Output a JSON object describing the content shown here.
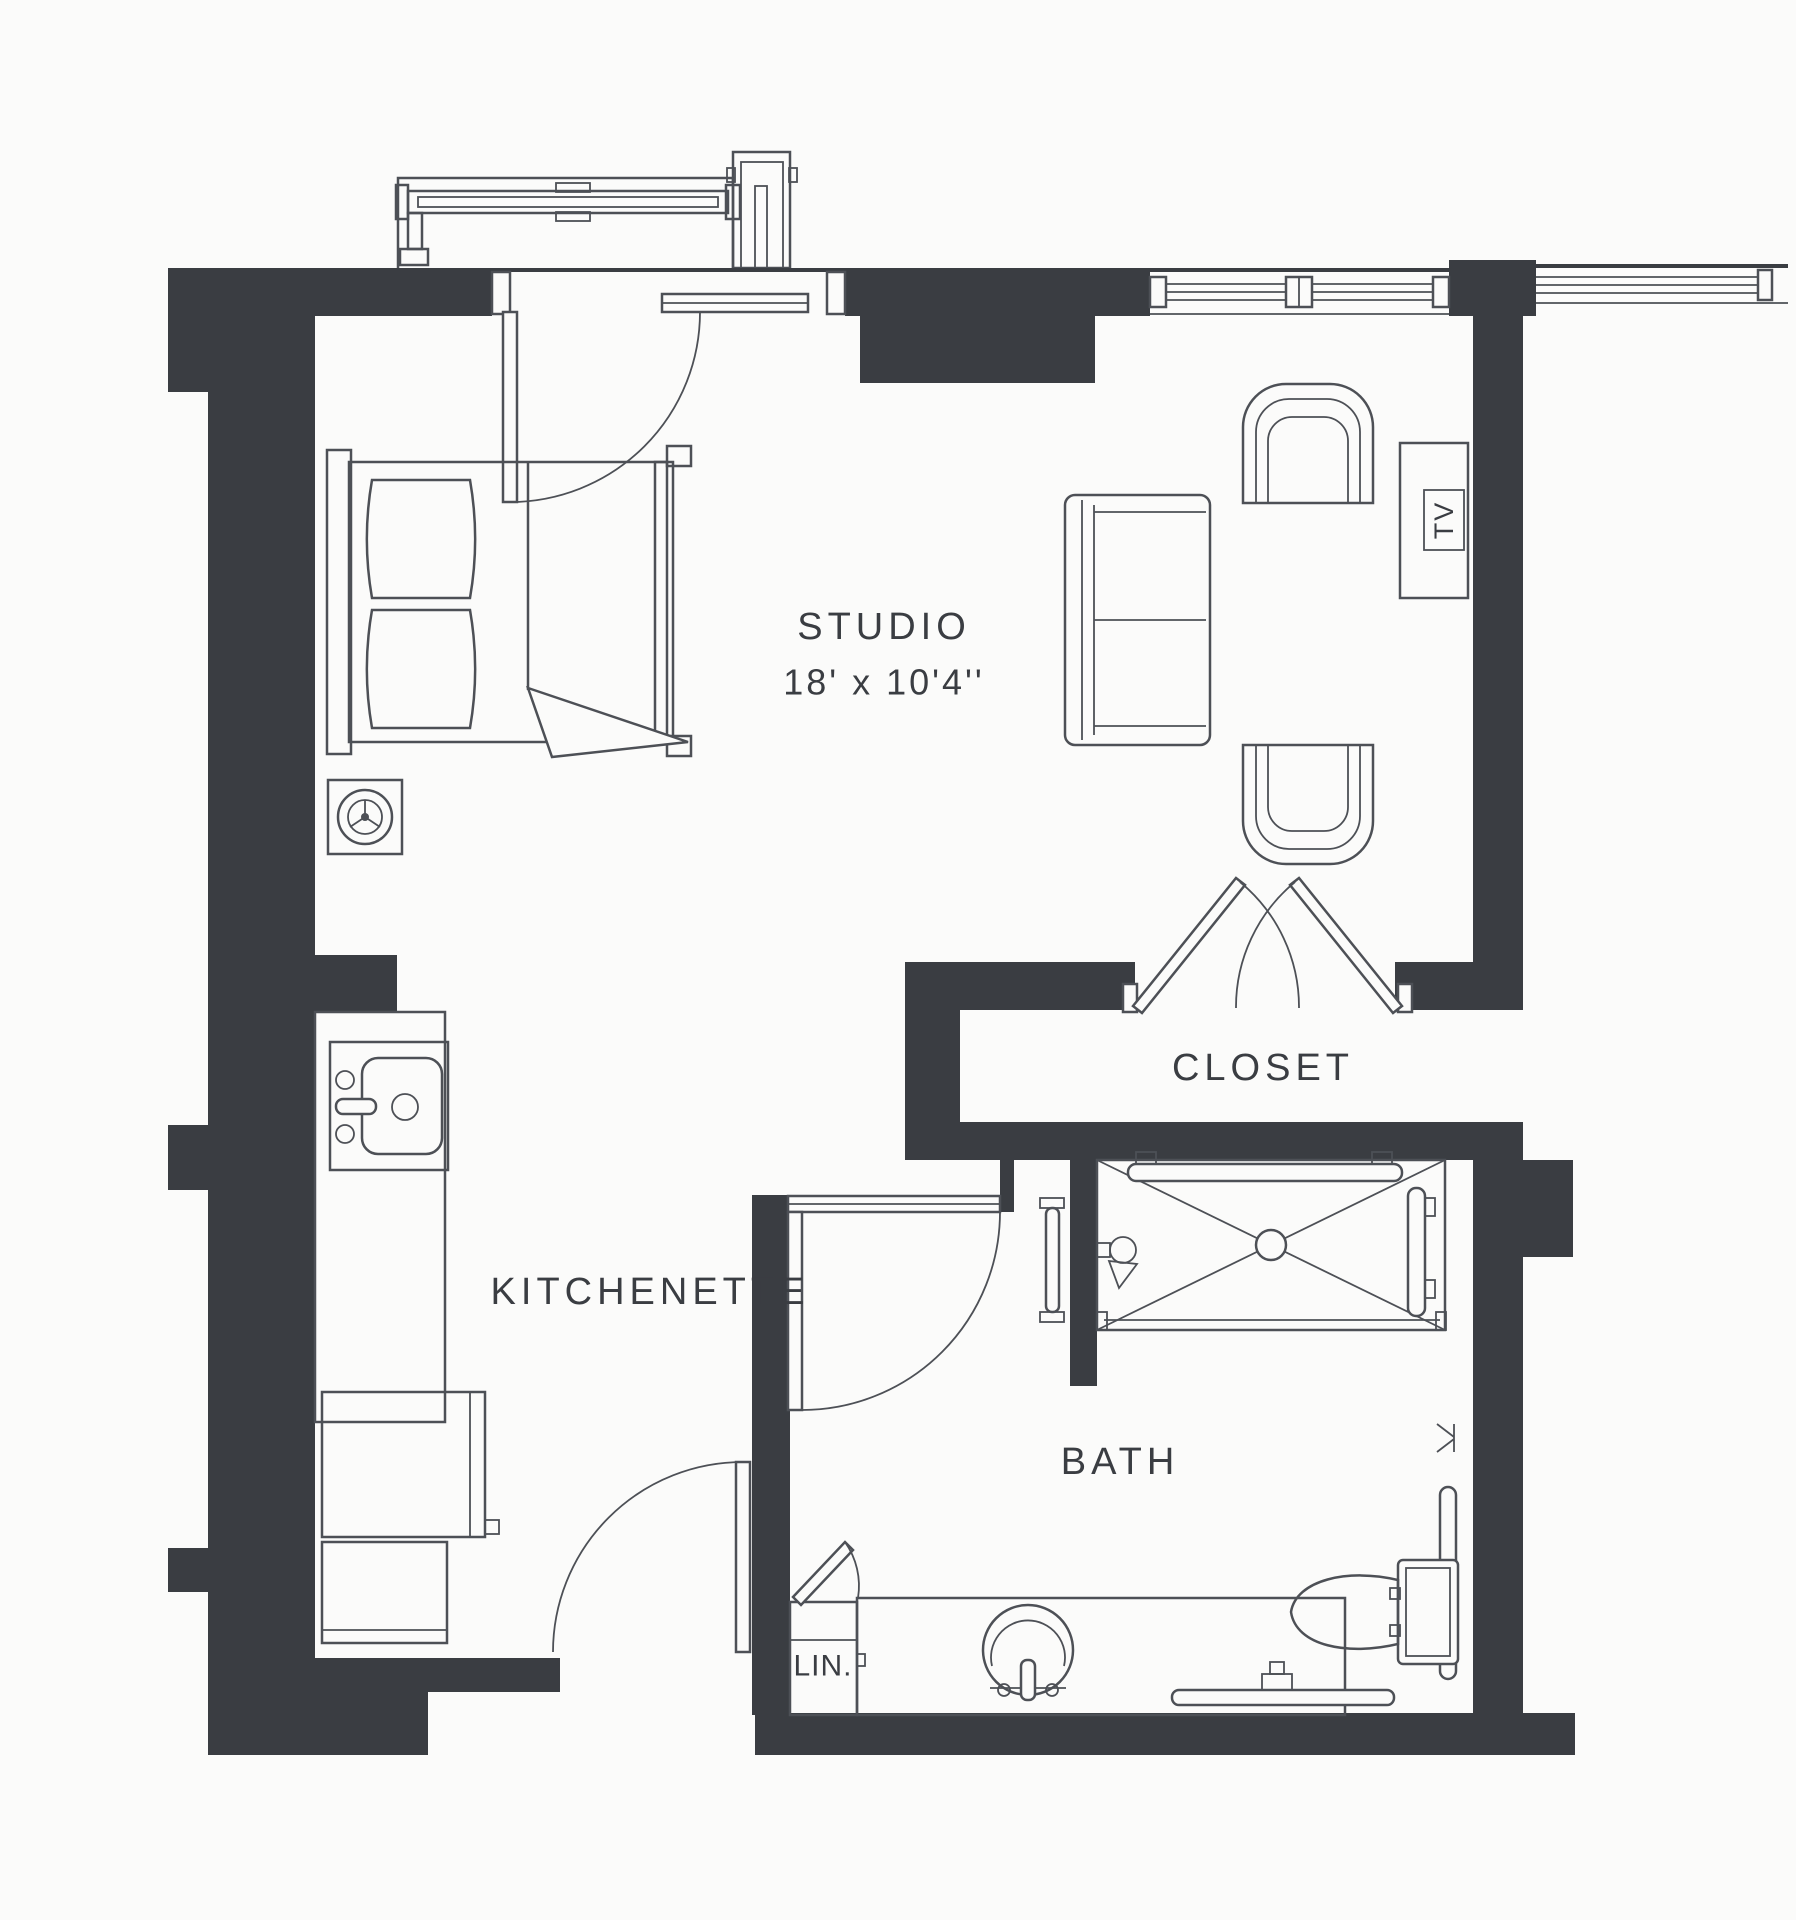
{
  "floorplan": {
    "title": "Studio Floor Plan",
    "rooms": {
      "studio": {
        "name": "STUDIO",
        "dimensions": "18' x 10'4''"
      },
      "kitchenette": {
        "name": "KITCHENETTE"
      },
      "closet": {
        "name": "CLOSET"
      },
      "bath": {
        "name": "BATH"
      },
      "linen": {
        "name": "LIN."
      }
    },
    "fixtures": {
      "tv": "TV"
    },
    "colors": {
      "wall": "#3a3d42",
      "line": "#4d5056",
      "background": "#fbfbfa",
      "text": "#3a3d42"
    }
  }
}
